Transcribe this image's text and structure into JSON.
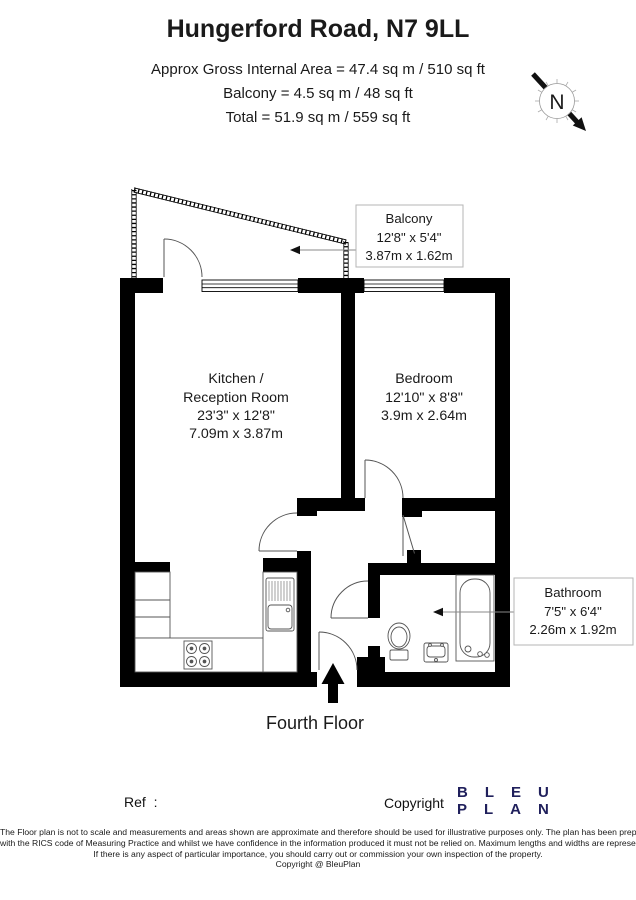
{
  "header": {
    "title": "Hungerford Road, N7 9LL",
    "area_line1": "Approx Gross Internal Area = 47.4 sq m / 510 sq ft",
    "area_line2": "Balcony = 4.5 sq m / 48 sq ft",
    "area_line3": "Total = 51.9 sq m / 559 sq ft"
  },
  "compass": {
    "north_label": "N"
  },
  "rooms": {
    "kitchen": {
      "name_line1": "Kitchen /",
      "name_line2": "Reception Room",
      "dims_imperial": "23'3\" x 12'8\"",
      "dims_metric": "7.09m x 3.87m"
    },
    "bedroom": {
      "name": "Bedroom",
      "dims_imperial": "12'10\" x 8'8\"",
      "dims_metric": "3.9m x 2.64m"
    },
    "balcony": {
      "name": "Balcony",
      "dims_imperial": "12'8\" x 5'4\"",
      "dims_metric": "3.87m x 1.62m"
    },
    "bathroom": {
      "name": "Bathroom",
      "dims_imperial": "7'5\" x 6'4\"",
      "dims_metric": "2.26m x 1.92m"
    }
  },
  "floor_label": "Fourth Floor",
  "footer": {
    "ref_label": "Ref  :",
    "copyright_label": "Copyright",
    "logo_line1": "BLEU",
    "logo_line2": "PLAN",
    "disclaimer_line1": "The Floor plan is not to scale and measurements and areas shown are approximate and therefore should be used for illustrative purposes only. The plan has been prepared in accordance",
    "disclaimer_line2": "with the RICS code of Measuring Practice and whilst we have confidence in the information produced it must not be relied on. Maximum lengths and widths are represented on the floor plan.",
    "disclaimer_line3": "If there is any aspect of particular importance, you should carry out or commission your own inspection of the property.",
    "disclaimer_line4": "Copyright @ BleuPlan"
  },
  "colors": {
    "wall": "#000000",
    "logo_navy": "#20205c",
    "label_box_border": "#b5b5b5"
  }
}
